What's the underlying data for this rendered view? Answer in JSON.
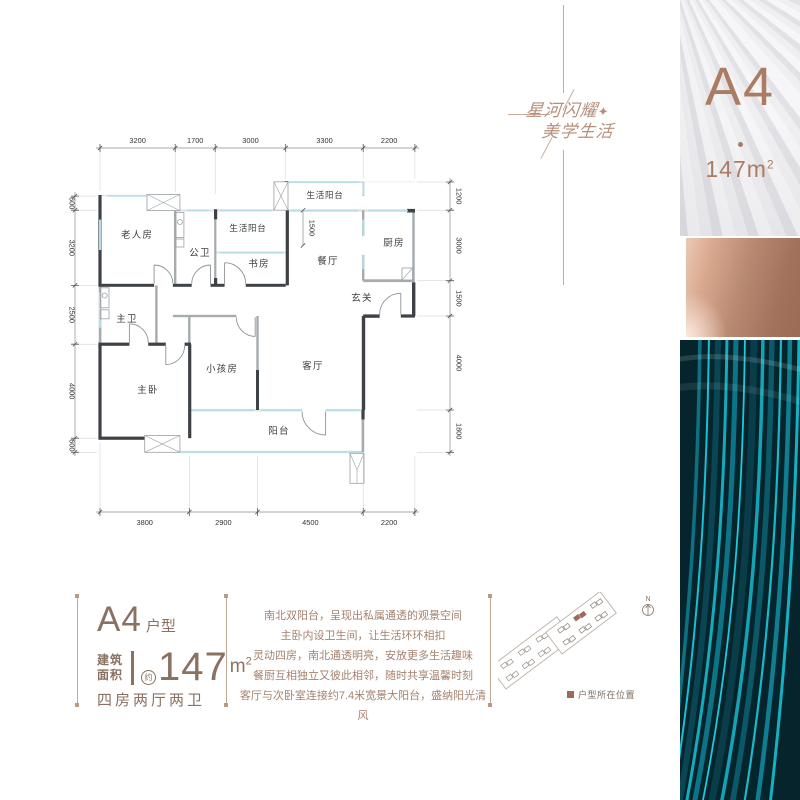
{
  "slogan": {
    "line1": "星河闪耀",
    "line2": "美学生活",
    "star": "✦"
  },
  "unit_badge": {
    "code": "A4",
    "area_base": "147m",
    "area_sup": "2"
  },
  "floor_plan": {
    "rooms": {
      "elder": "老人房",
      "guest_bath": "公卫",
      "service_balcony_1": "生活阳台",
      "study": "书房",
      "service_balcony_2": "生活阳台",
      "dining": "餐厅",
      "kitchen": "厨房",
      "foyer": "玄关",
      "master_bath": "主卫",
      "master_bed": "主卧",
      "kids_bed": "小孩房",
      "living": "客厅",
      "balcony": "阳台"
    },
    "dims_top": [
      "3200",
      "1700",
      "3000",
      "3300",
      "2200"
    ],
    "dims_bottom": [
      "3800",
      "2900",
      "4500",
      "2200"
    ],
    "dims_left": [
      "600",
      "3200",
      "2500",
      "4000",
      "600"
    ],
    "dims_right": [
      "1200",
      "3000",
      "1500",
      "4000",
      "1800"
    ],
    "inner_dim": "1500"
  },
  "info": {
    "unit_code": "A4",
    "unit_suffix": "户型",
    "area_label_line1": "建筑",
    "area_label_line2": "面积",
    "area_approx": "约",
    "area_value": "147",
    "area_unit_base": "m",
    "area_unit_sup": "2",
    "layout_text": "四房两厅两卫",
    "description": [
      "南北双阳台，呈现出私属通透的观景空间",
      "主卧内设卫生间，让生活环环相扣",
      "灵动四房，南北通透明亮，安放更多生活趣味",
      "餐厨互相独立又彼此相邻，随时共享温馨时刻",
      "客厅与次卧室连接约7.4米宽景大阳台，盛纳阳光清风"
    ]
  },
  "site_map": {
    "north_label": "N",
    "legend_label": "户型所在位置"
  },
  "colors": {
    "accent_brown": "#8a7162",
    "desc_brown": "#a5826e",
    "slogan_brown": "#b68f7b",
    "badge_brown": "#ab7c62",
    "copper_dark": "#9b6b56",
    "copper_light": "#edc9b4",
    "teal_bg": "#05242c",
    "teal_bright": "#1abfd1",
    "plan_wall_dark": "#3e4246",
    "plan_wall_gray": "#a6abae",
    "plan_window_blue": "#b7dce8",
    "legend_square": "#9c6b58"
  }
}
